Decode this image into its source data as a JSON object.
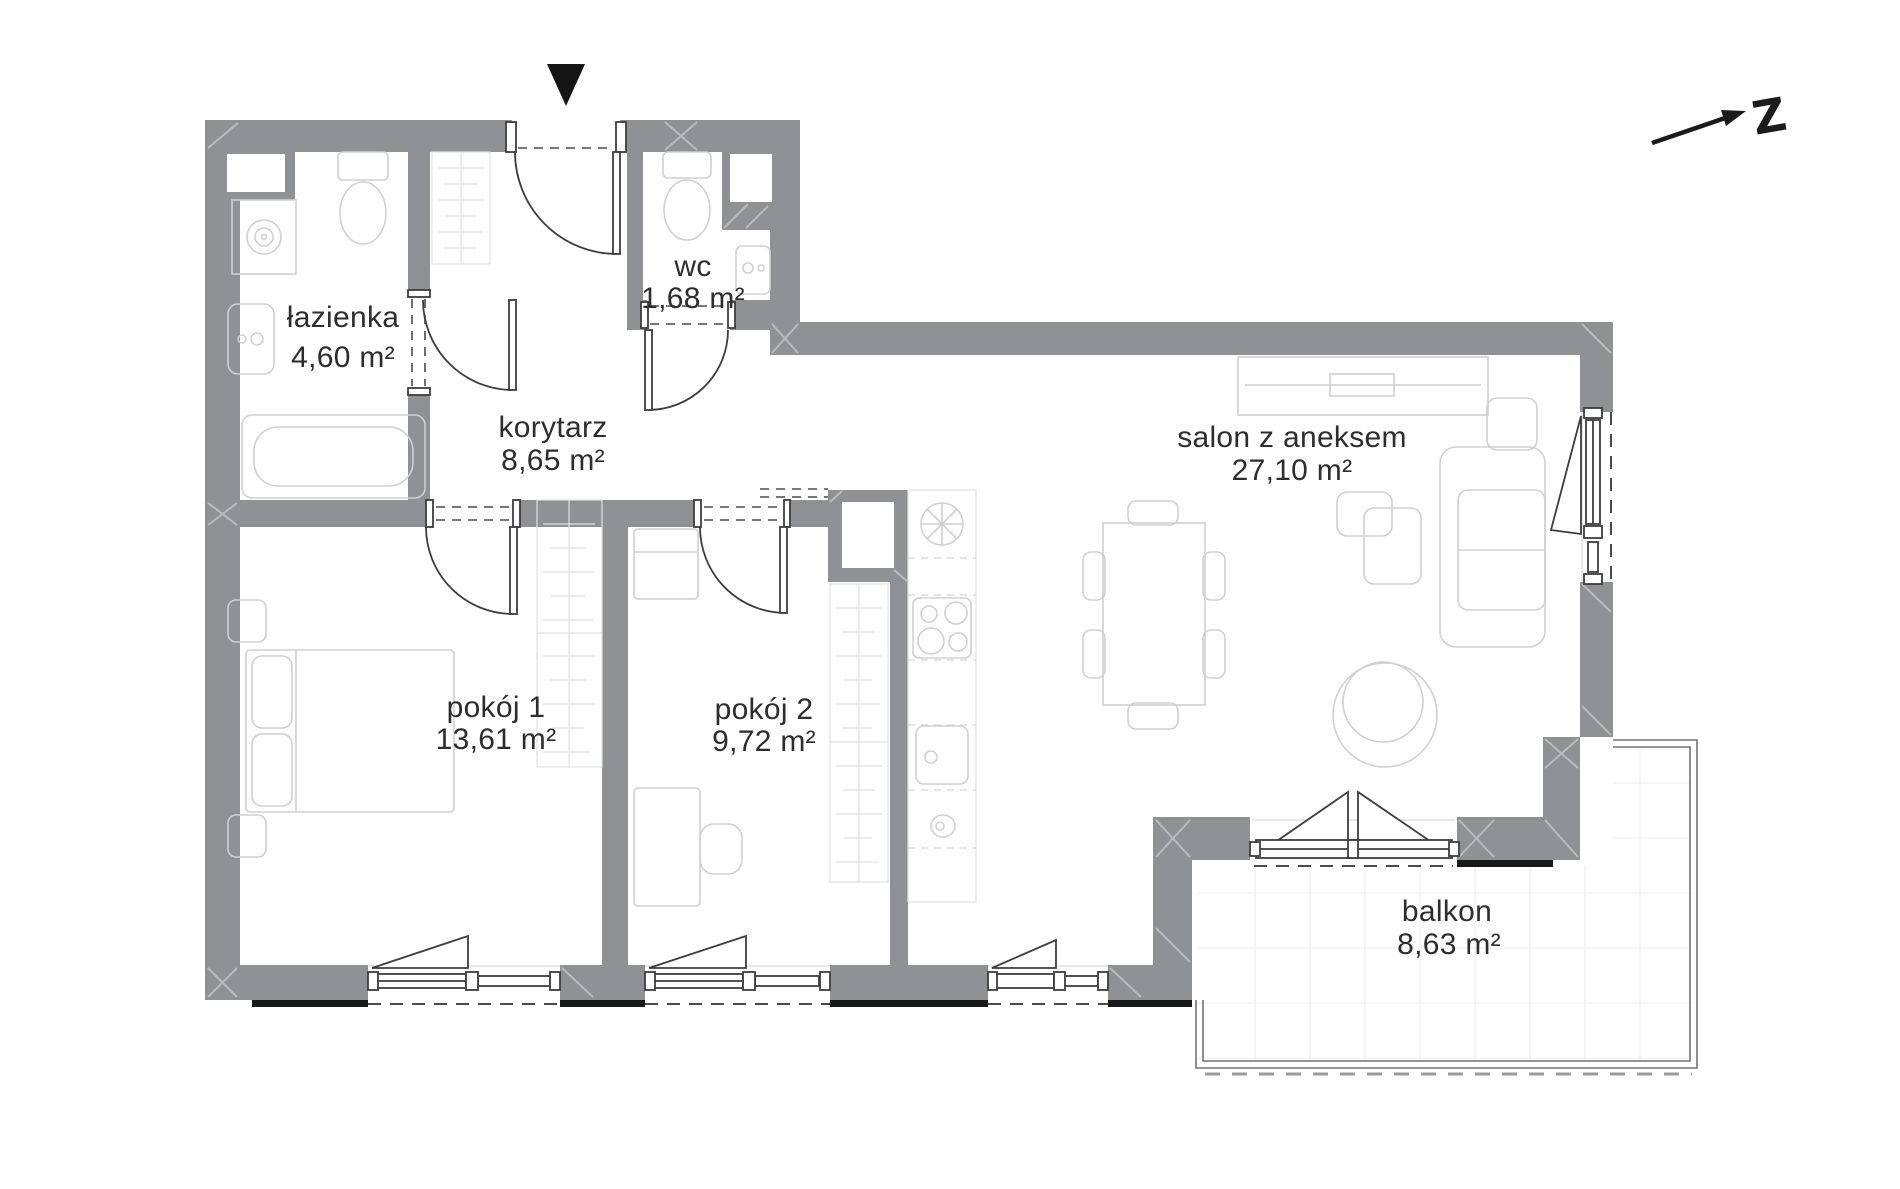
{
  "plan": {
    "rooms": [
      {
        "id": "lazienka",
        "name": "łazienka",
        "area": "4,60 m²"
      },
      {
        "id": "wc",
        "name": "wc",
        "area": "1,68 m²"
      },
      {
        "id": "korytarz",
        "name": "korytarz",
        "area": "8,65 m²"
      },
      {
        "id": "salon",
        "name": "salon z aneksem",
        "area": "27,10 m²"
      },
      {
        "id": "pokoj1",
        "name": "pokój 1",
        "area": "13,61 m²"
      },
      {
        "id": "pokoj2",
        "name": "pokój 2",
        "area": "9,72 m²"
      },
      {
        "id": "balkon",
        "name": "balkon",
        "area": "8,63 m²"
      }
    ],
    "compass": {
      "letter": "Z"
    },
    "colors": {
      "wall": "#8f9194",
      "text": "#2d2d2e",
      "black": "#19191a",
      "furniture": "#cfd0d1"
    }
  }
}
